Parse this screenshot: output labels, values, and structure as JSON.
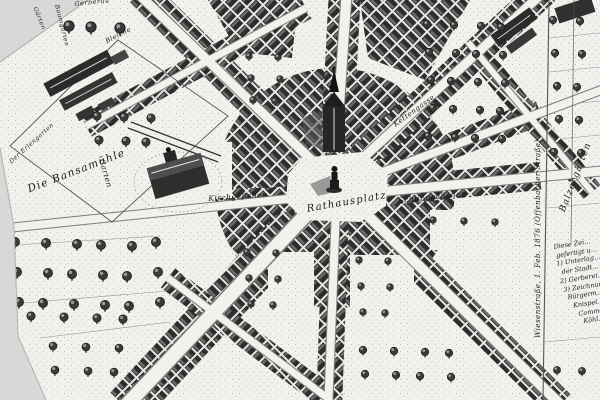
{
  "map": {
    "kind": "engraved historical town plan, bird's-eye view, monochrome",
    "colors": {
      "ink": "#1f1f1f",
      "paper": "#f2f1ec",
      "sheet_margin": "#d8d8d8"
    },
    "labels": {
      "plot_bansamuehle": "Die Bansamühle",
      "plot_erlengarten": "Der Erlengarten",
      "garten_west": "Garten",
      "gaerten_corner": "Gärten",
      "baumgarten": "Baumgarten",
      "gerberau": "Gerberau",
      "bleiche": "Bleiche",
      "street_kirchgaesschen": "Kirchgäßchen",
      "square_rathausplatz": "Rathausplatz",
      "street_schlippgaesschen": "Schlippgäßchen",
      "street_kettengasse": "Kettengasse",
      "balzergaerten": "Balzergärten",
      "street_wiesenstrasse": "Wiesenstraße, 1. Feb. 1876  (Offenbacher Straße)",
      "notes": [
        "Diese Zei…",
        "gefertigt u…",
        "1) Unterlag…",
        "der Stadt…",
        "2) Gerberei…",
        "3) Zeichnun…",
        "Bürgerm.…",
        "Knispel…",
        "Commer…",
        "Köhl…"
      ]
    }
  }
}
